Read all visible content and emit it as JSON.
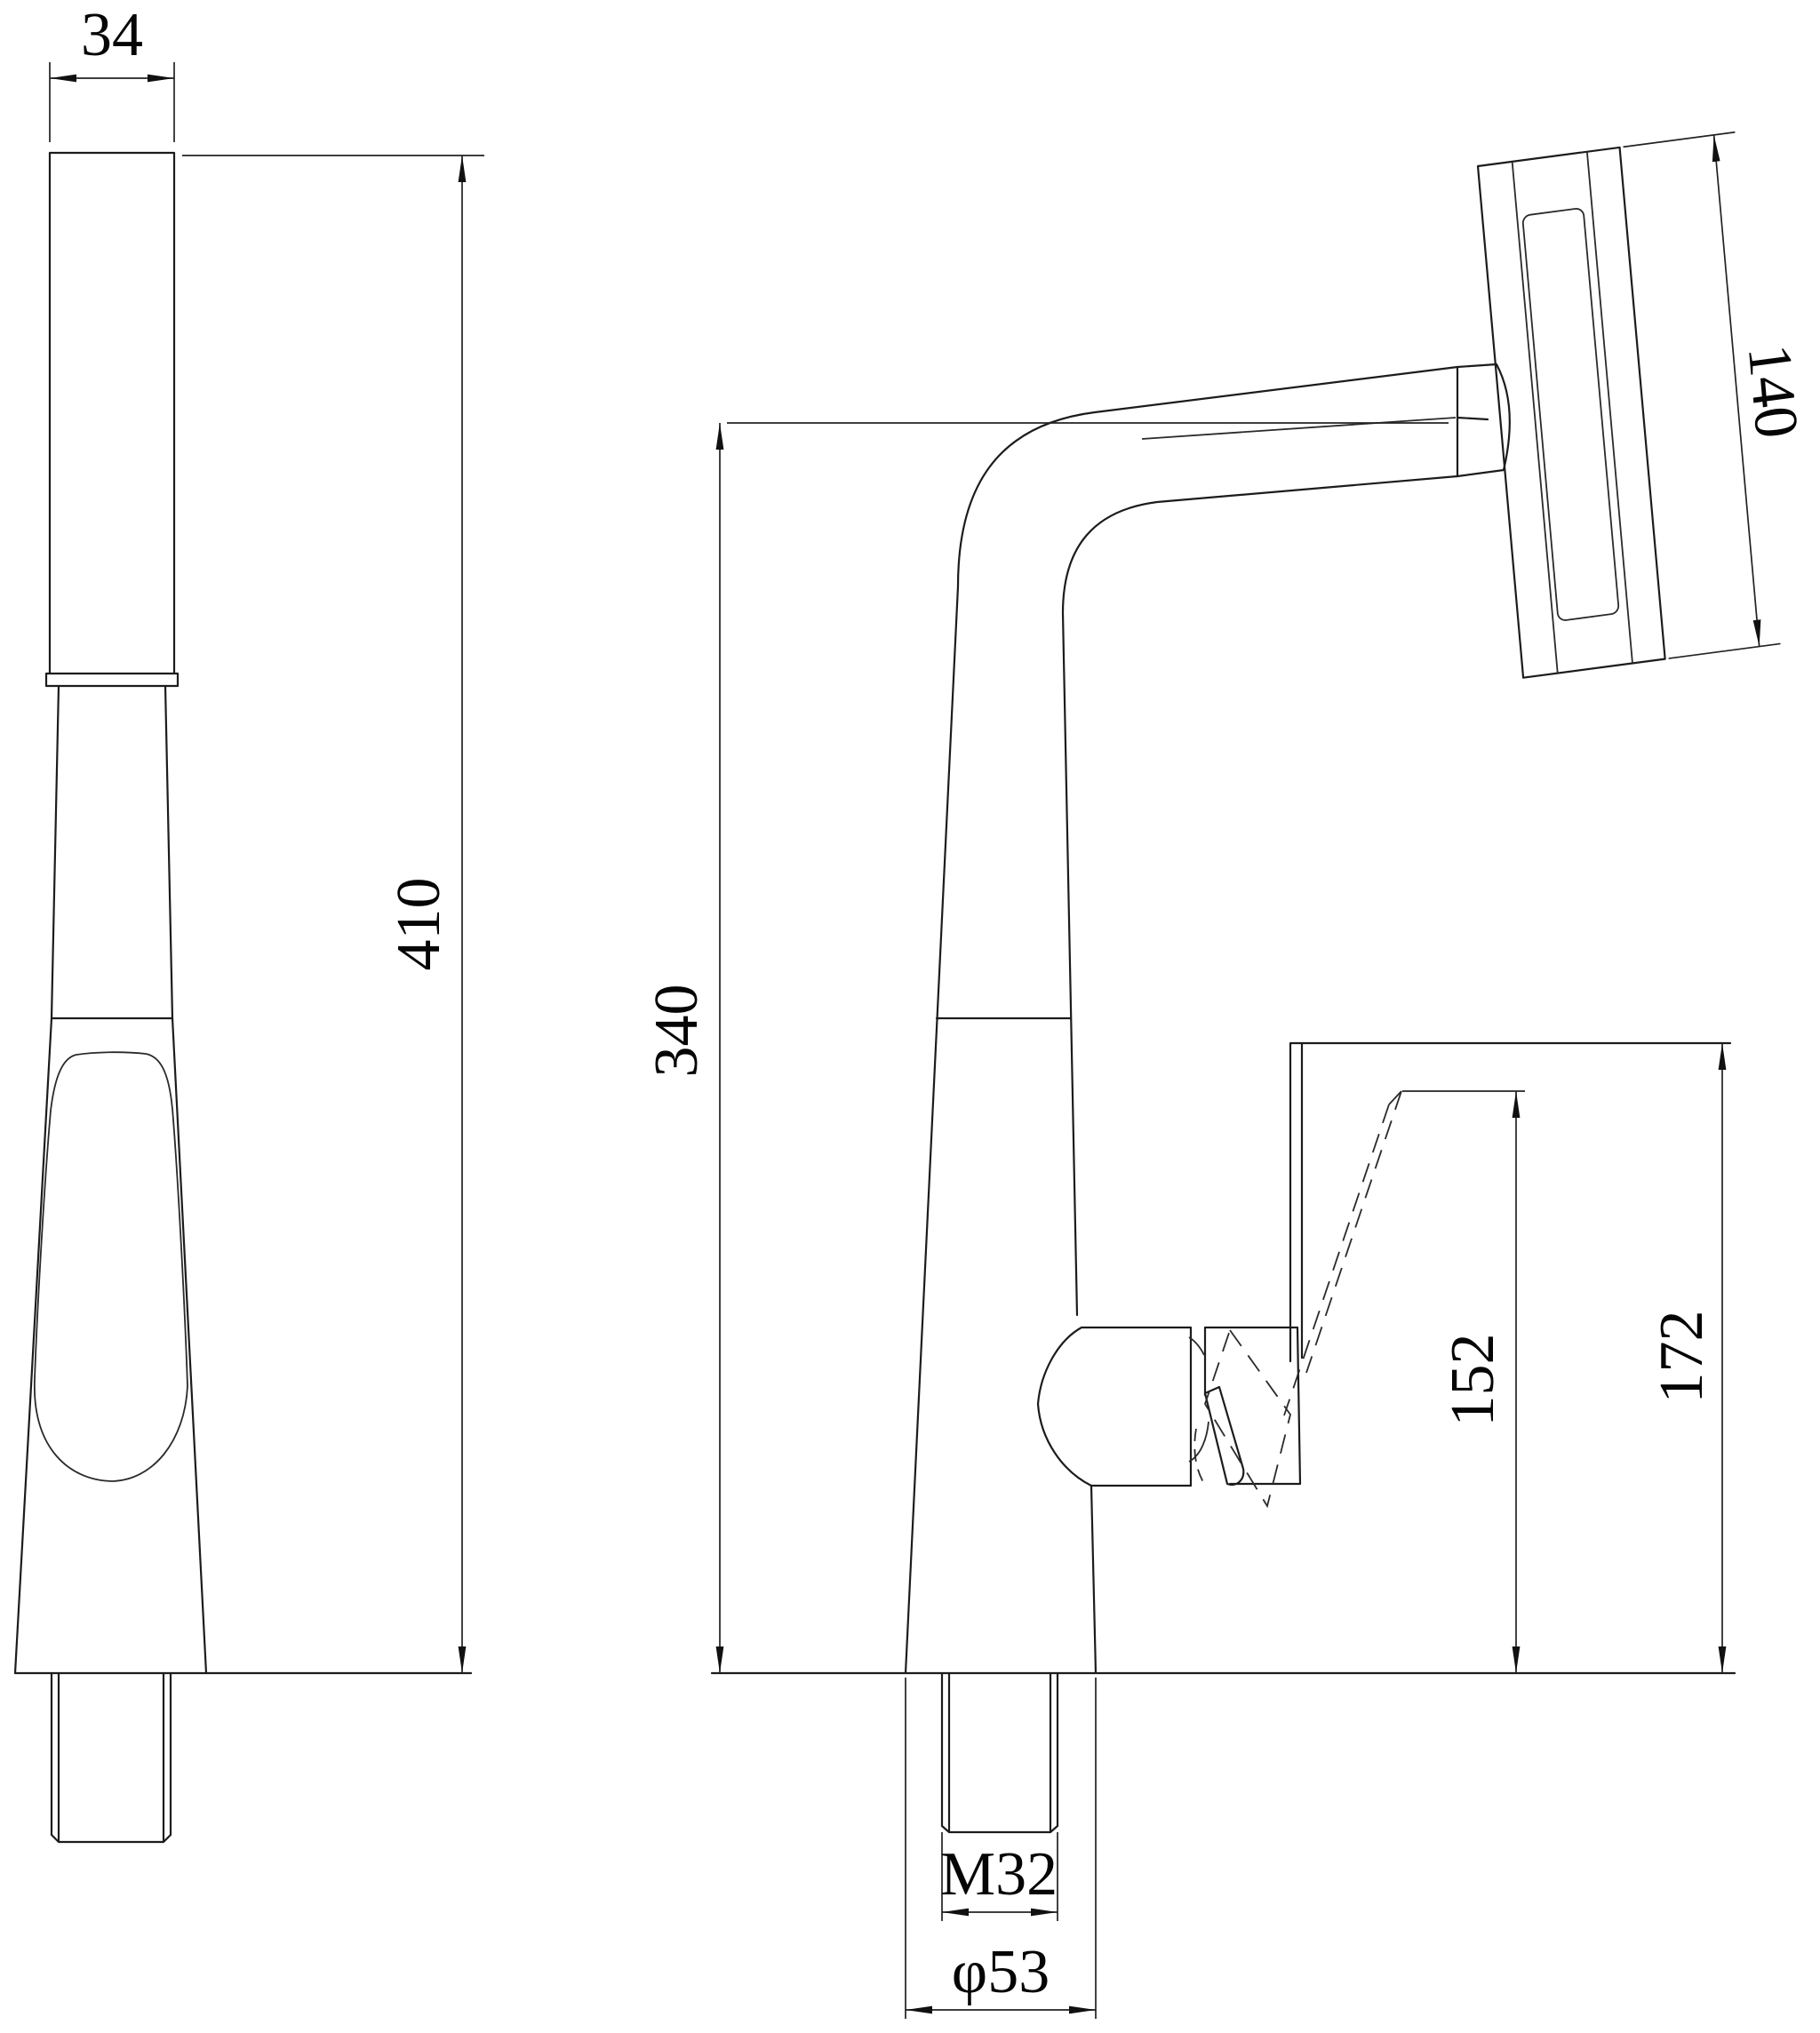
{
  "drawing": {
    "type": "faucet-technical-drawing",
    "views": {
      "front_view": "pull-out spray wand / faucet front elevation",
      "side_view": "kitchen faucet side elevation with handle positions"
    },
    "dimensions": {
      "d34": "34",
      "d410": "410",
      "d340": "340",
      "d140": "140",
      "d152": "152",
      "d172": "172",
      "m32": "M32",
      "phi53": "φ53"
    },
    "line_color": "#1c1c1c",
    "background": "#ffffff"
  }
}
